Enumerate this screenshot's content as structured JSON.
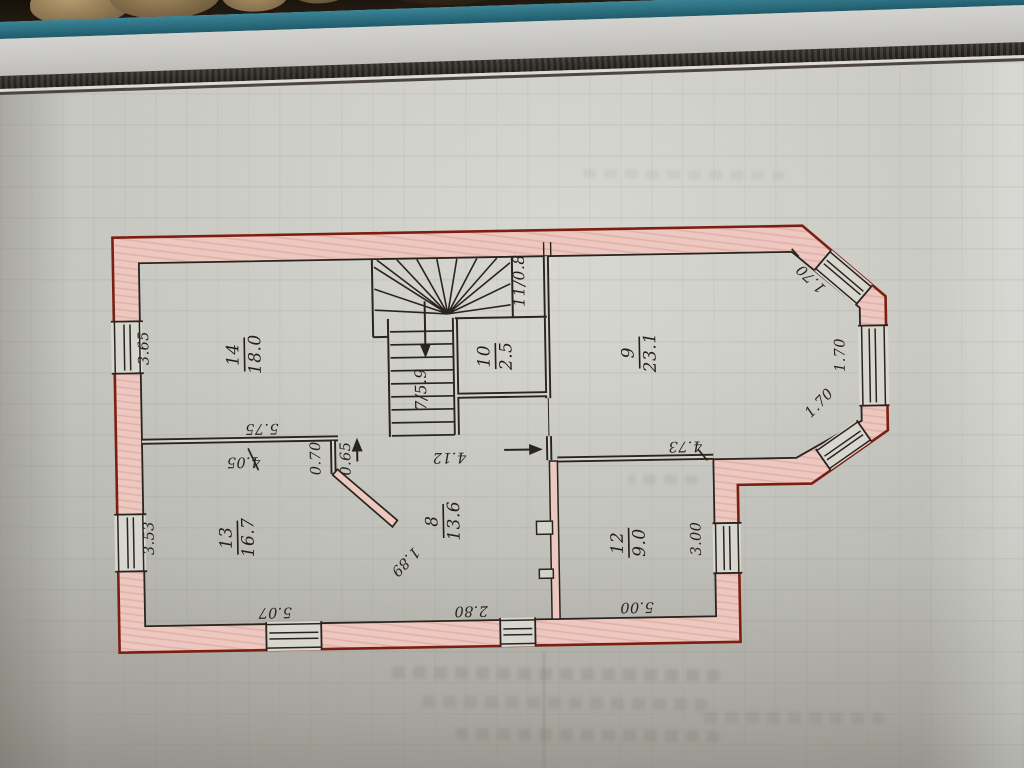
{
  "document_type": "hand-drawn floor plan photographed on a squared notepad, plan rotated 90 degrees",
  "colors": {
    "paper": "#d2d2cb",
    "wall_fill_pink": "#ecc8c0",
    "wall_outer_outline_red": "#7c1f12",
    "ink": "#2a241e",
    "notebook_edge_teal": "#2e7386",
    "binding_stripe_dark": "#2a2520"
  },
  "rooms": [
    {
      "number": "14",
      "area": "18.0"
    },
    {
      "number": "13",
      "area": "16.7"
    },
    {
      "number": "8",
      "area": "13.6"
    },
    {
      "number": "12",
      "area": "9.0"
    },
    {
      "number": "9",
      "area": "23.1"
    },
    {
      "number": "10",
      "area": "2.5"
    },
    {
      "label": "7/5.9"
    },
    {
      "label": "11/0.8"
    }
  ],
  "dimensions": {
    "room14_height": "3.65",
    "room14_width": "5.75",
    "room13_top_width": "4.05",
    "door_width_a": "0.70",
    "door_width_b": "0.65",
    "room13_height": "3.53",
    "room13_bottom_width": "5.07",
    "diagonal_wall": "1.89",
    "room8_bottom_width": "2.80",
    "room8_top_width": "4.12",
    "room9_bottom_width": "4.73",
    "room12_bottom_width": "5.00",
    "room12_height": "3.00",
    "bay_window_top": "1.70",
    "bay_window_middle": "1.70",
    "bay_window_bottom": "1.70"
  }
}
